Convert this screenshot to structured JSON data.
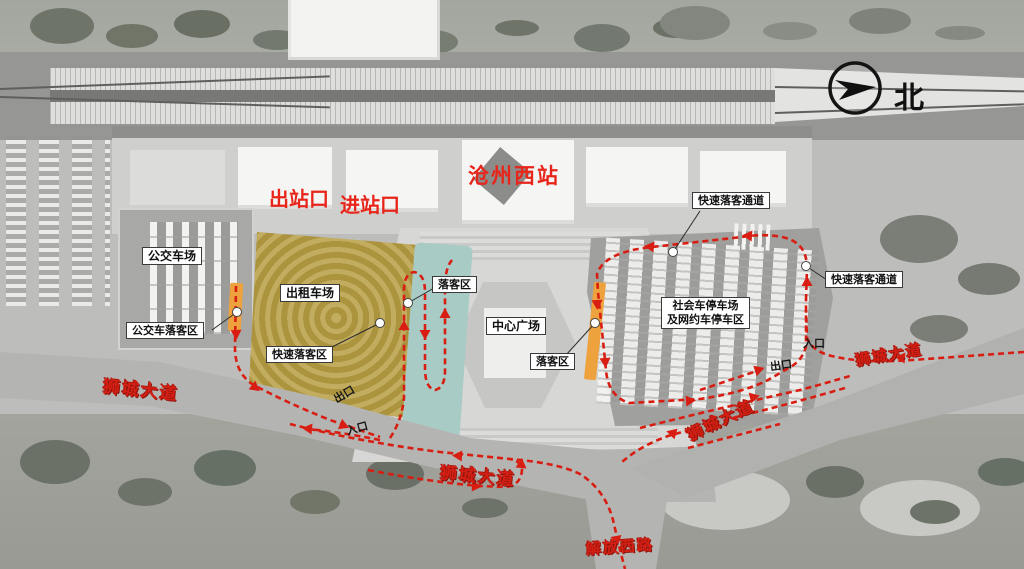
{
  "compass": {
    "north_label": "北"
  },
  "station": {
    "name": "沧州西站",
    "exit_gate": "出站口",
    "entry_gate": "进站口"
  },
  "labels": {
    "bus_yard": "公交车场",
    "bus_dropoff": "公交车落客区",
    "taxi_yard": "出租车场",
    "quick_dropoff_zone": "快速落客区",
    "dropoff_left": "落客区",
    "dropoff_right": "落客区",
    "central_plaza": "中心广场",
    "social_parking_line1": "社会车停车场",
    "social_parking_line2": "及网约车停车区",
    "channel_top": "快速落客通道",
    "channel_right": "快速落客通道"
  },
  "roads": {
    "shicheng_left": "狮城大道",
    "shicheng_center": "狮城大道",
    "shicheng_diagonal": "狮城大道",
    "shicheng_right": "狮城大道",
    "jiefang_west": "解放西路"
  },
  "gates": {
    "taxi_exit": "出口",
    "taxi_entrance": "入口",
    "parking_exit": "出口",
    "parking_entrance": "入口"
  },
  "colors": {
    "route_red": "#d81e12",
    "station_label_red": "#e8251a",
    "road_text_red": "#d61f14",
    "taxi_gold": "#b59c42",
    "dropoff_teal": "#a9cbc5",
    "dropoff_orange": "#eda23d"
  }
}
